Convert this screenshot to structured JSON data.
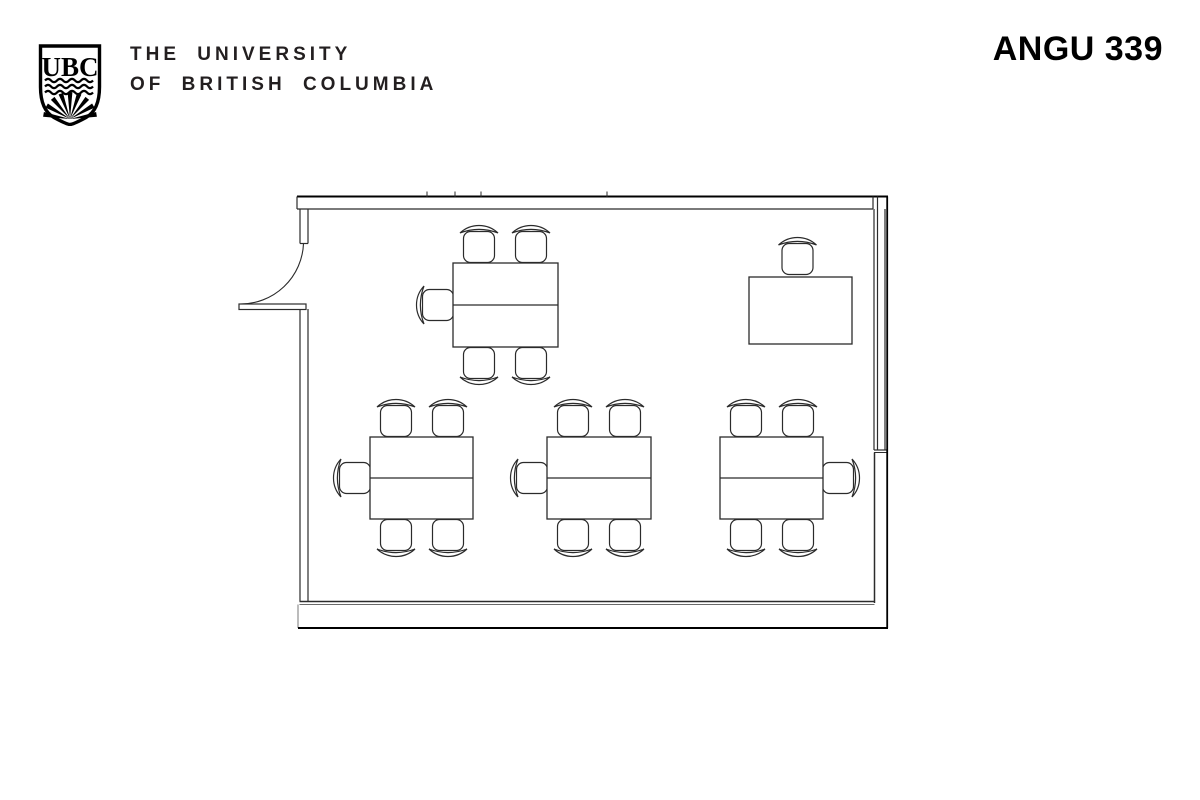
{
  "header": {
    "logo_text": "UBC",
    "university_line1": "THE UNIVERSITY",
    "university_line2": "OF BRITISH COLUMBIA",
    "room_label": "ANGU 339"
  },
  "floor_plan": {
    "colors": {
      "line": "#2b2b2b",
      "wall_outer": "#000000",
      "background": "#ffffff"
    },
    "tables": [
      {
        "name": "group-table-1",
        "x": 453,
        "y": 263,
        "w": 105,
        "h": 84,
        "chairs_top": 2,
        "chairs_bottom": 2,
        "chairs_left": 1,
        "chairs_right": 0
      },
      {
        "name": "group-table-2",
        "x": 370,
        "y": 437,
        "w": 103,
        "h": 82,
        "chairs_top": 2,
        "chairs_bottom": 2,
        "chairs_left": 1,
        "chairs_right": 0
      },
      {
        "name": "group-table-3",
        "x": 547,
        "y": 437,
        "w": 104,
        "h": 82,
        "chairs_top": 2,
        "chairs_bottom": 2,
        "chairs_left": 1,
        "chairs_right": 0
      },
      {
        "name": "group-table-4",
        "x": 720,
        "y": 437,
        "w": 103,
        "h": 82,
        "chairs_top": 2,
        "chairs_bottom": 2,
        "chairs_left": 0,
        "chairs_right": 1
      }
    ],
    "instructor_desk": {
      "name": "instructor-desk",
      "x": 749,
      "y": 277,
      "w": 103,
      "h": 67,
      "chairs_top": 1
    }
  }
}
